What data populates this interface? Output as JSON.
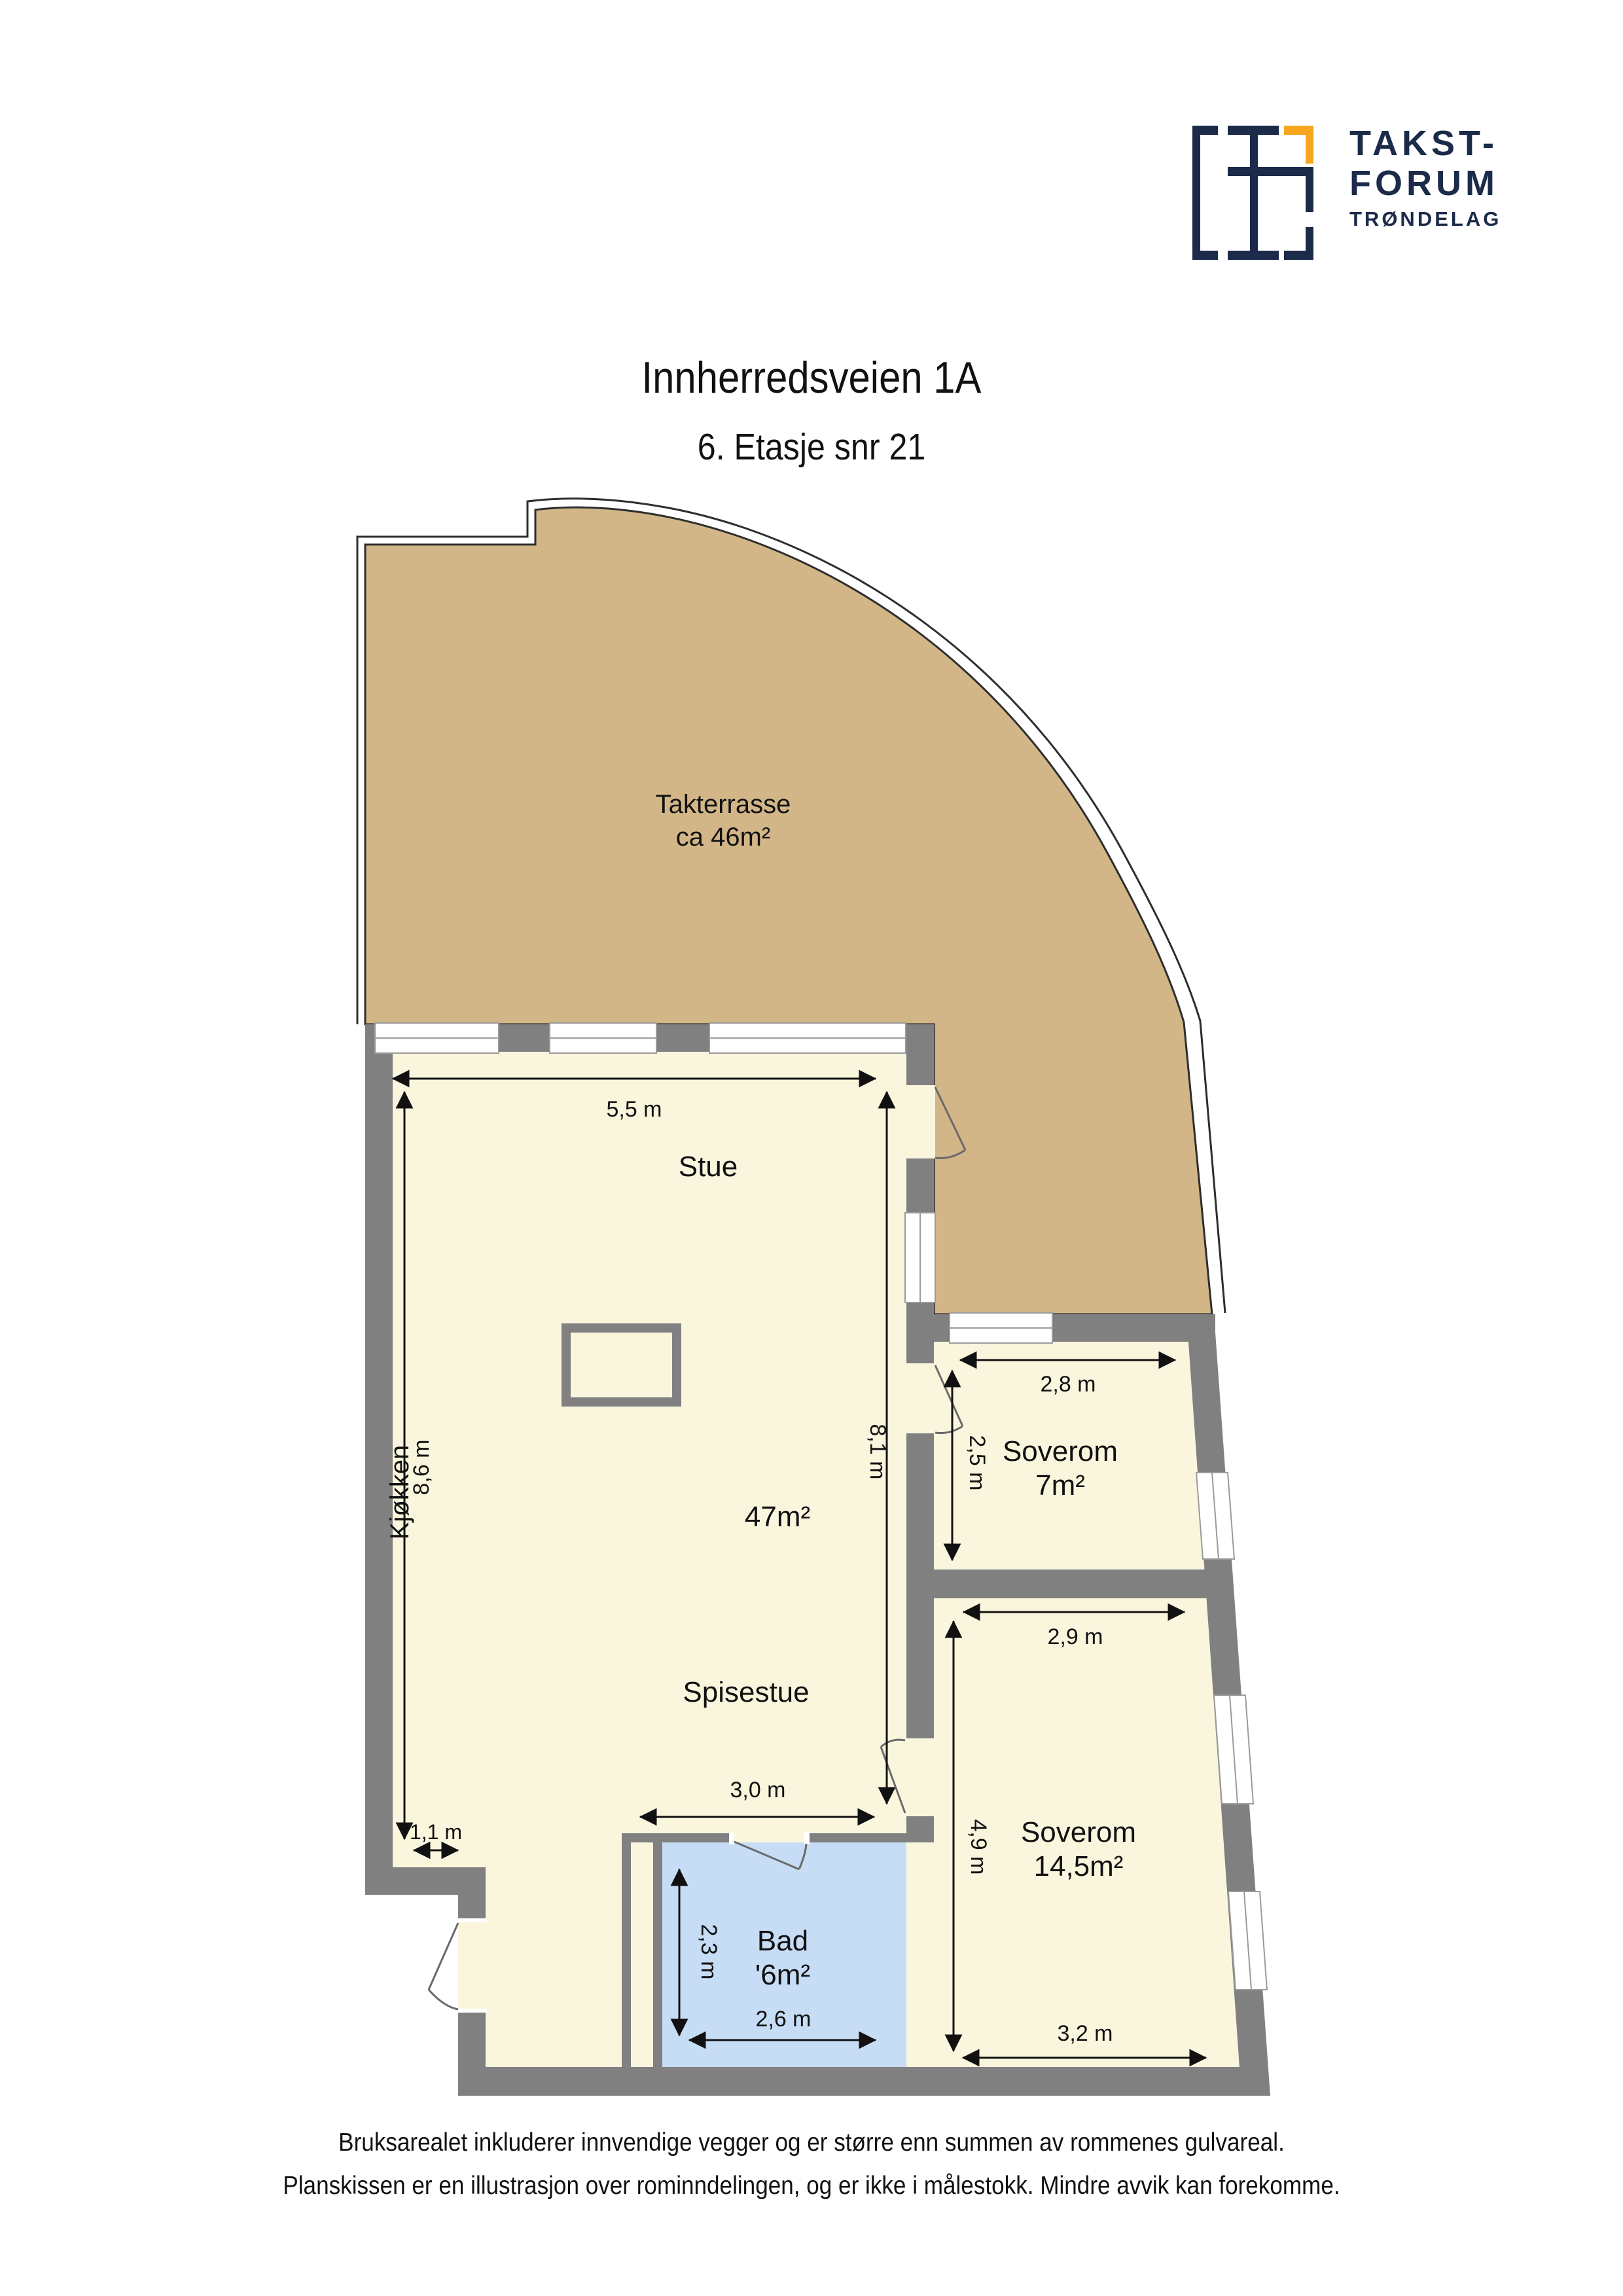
{
  "header": {
    "logo": {
      "word1": "TAKST-",
      "word2": "FORUM",
      "word3": "TRØNDELAG",
      "navy": "#1C2B4A",
      "orange": "#F6A61C"
    },
    "title": "Innherredsveien 1A",
    "subtitle": "6. Etasje snr 21"
  },
  "plan": {
    "colors": {
      "floor": "#FAF6DE",
      "terrace": "#D2B688",
      "wall": "#808080",
      "bath": "#C7DDF6",
      "outline": "#2E2E2E"
    },
    "terrace": {
      "name": "Takterrasse",
      "area": "ca 46m²"
    },
    "stue": {
      "name": "Stue",
      "area": "47m²"
    },
    "kjokken": {
      "name": "Kjøkken"
    },
    "spisestue": {
      "name": "Spisestue"
    },
    "soverom_small": {
      "name": "Soverom",
      "area": "7m²"
    },
    "soverom_large": {
      "name": "Soverom",
      "area": "14,5m²"
    },
    "bad": {
      "name": "Bad",
      "area": "'6m²"
    },
    "dims": {
      "stue_w": "5,5 m",
      "kjokken_h": "8,6 m",
      "stue_h": "8,1 m",
      "spisestue_w": "3,0 m",
      "kjokken_w": "1,1 m",
      "bad_h": "2,3 m",
      "bad_w": "2,6 m",
      "sov1_w": "2,8 m",
      "sov1_h": "2,5 m",
      "sov2_w": "2,9 m",
      "sov2_h": "4,9 m",
      "sov2_w2": "3,2 m"
    }
  },
  "footer": {
    "line1": "Bruksarealet inkluderer innvendige vegger og er større enn summen av rommenes gulvareal.",
    "line2": "Planskissen er en illustrasjon over rominndelingen, og er ikke i målestokk. Mindre avvik kan forekomme."
  }
}
